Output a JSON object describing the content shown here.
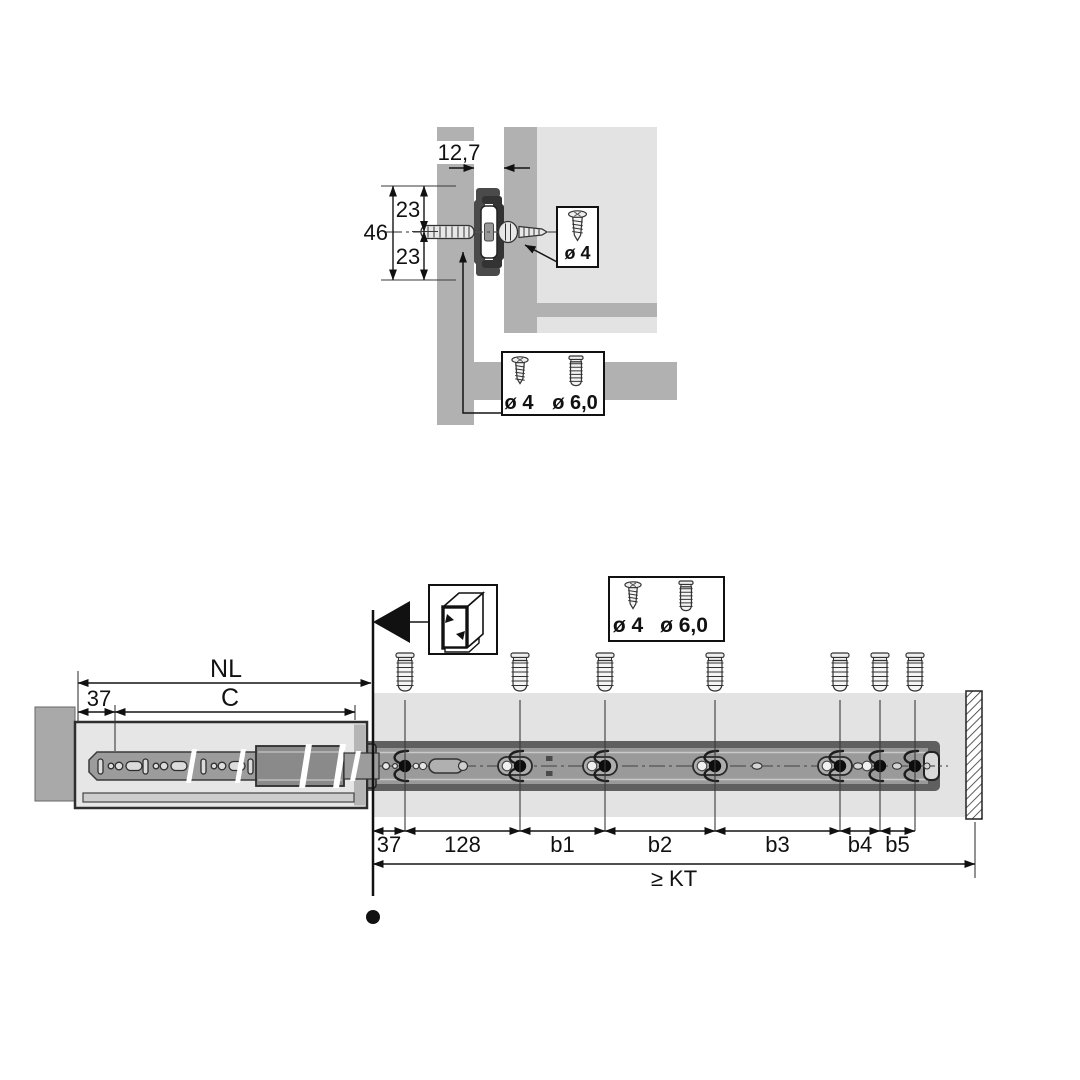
{
  "top_view": {
    "gap_width": "12,7",
    "total_height": "46",
    "upper_offset": "23",
    "lower_offset": "23",
    "drawer_screw_label": "ø 4",
    "cabinet_screw_labels": [
      "ø 4",
      "ø 6,0"
    ]
  },
  "side_view": {
    "rail_length_label": "NL",
    "front_offset_label": "37",
    "adjust_range_label": "C",
    "screw_labels": [
      "ø 4",
      "ø 6,0"
    ],
    "hole_spacing_labels": [
      "37",
      "128",
      "b1",
      "b2",
      "b3",
      "b4",
      "b5"
    ],
    "min_depth_label": "≥ KT"
  },
  "icons": {
    "euro_screw": "euro-screw-icon",
    "countersunk_screw": "countersunk-screw-icon",
    "cabinet": "cabinet-front-icon",
    "pointer": "front-edge-arrow-icon"
  },
  "colors": {
    "panel": "#b1b1b1",
    "panel_light": "#e3e3e3",
    "rail_outer": "#5f5f5f",
    "rail_web": "#9a9a9a",
    "line": "#141414"
  }
}
